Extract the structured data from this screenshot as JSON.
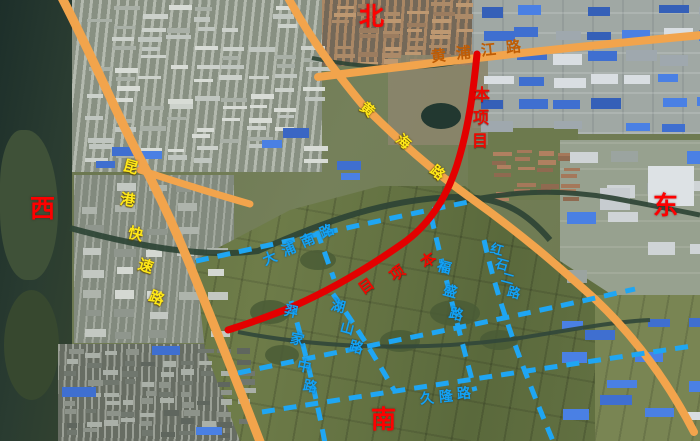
{
  "map": {
    "compass": {
      "north": "北",
      "south": "南",
      "east": "东",
      "west": "西"
    },
    "legend_colors": {
      "existing_road": "#f2a44c",
      "project_road": "#e30000",
      "planned_road": "#1fa6f3",
      "existing_label_yellow": "#ffe818",
      "existing_label_orange": "#bf5c04"
    },
    "roads": {
      "expressway": {
        "label": "昆港快速路",
        "status": "existing"
      },
      "huangpu": {
        "label": "黄浦江路",
        "status": "existing"
      },
      "coastal": {
        "label": "黄海路",
        "status": "existing"
      },
      "project": {
        "label": "本项目",
        "status": "project"
      },
      "planned": [
        {
          "id": "dapunan",
          "label": "大浦南路"
        },
        {
          "id": "hushan",
          "label": "湖山路"
        },
        {
          "id": "yijia",
          "label": "羿家中路"
        },
        {
          "id": "fusheng",
          "label": "福盛路"
        },
        {
          "id": "hongshi",
          "label": "红石二路"
        },
        {
          "id": "jiulong",
          "label": "久隆路"
        }
      ]
    }
  }
}
